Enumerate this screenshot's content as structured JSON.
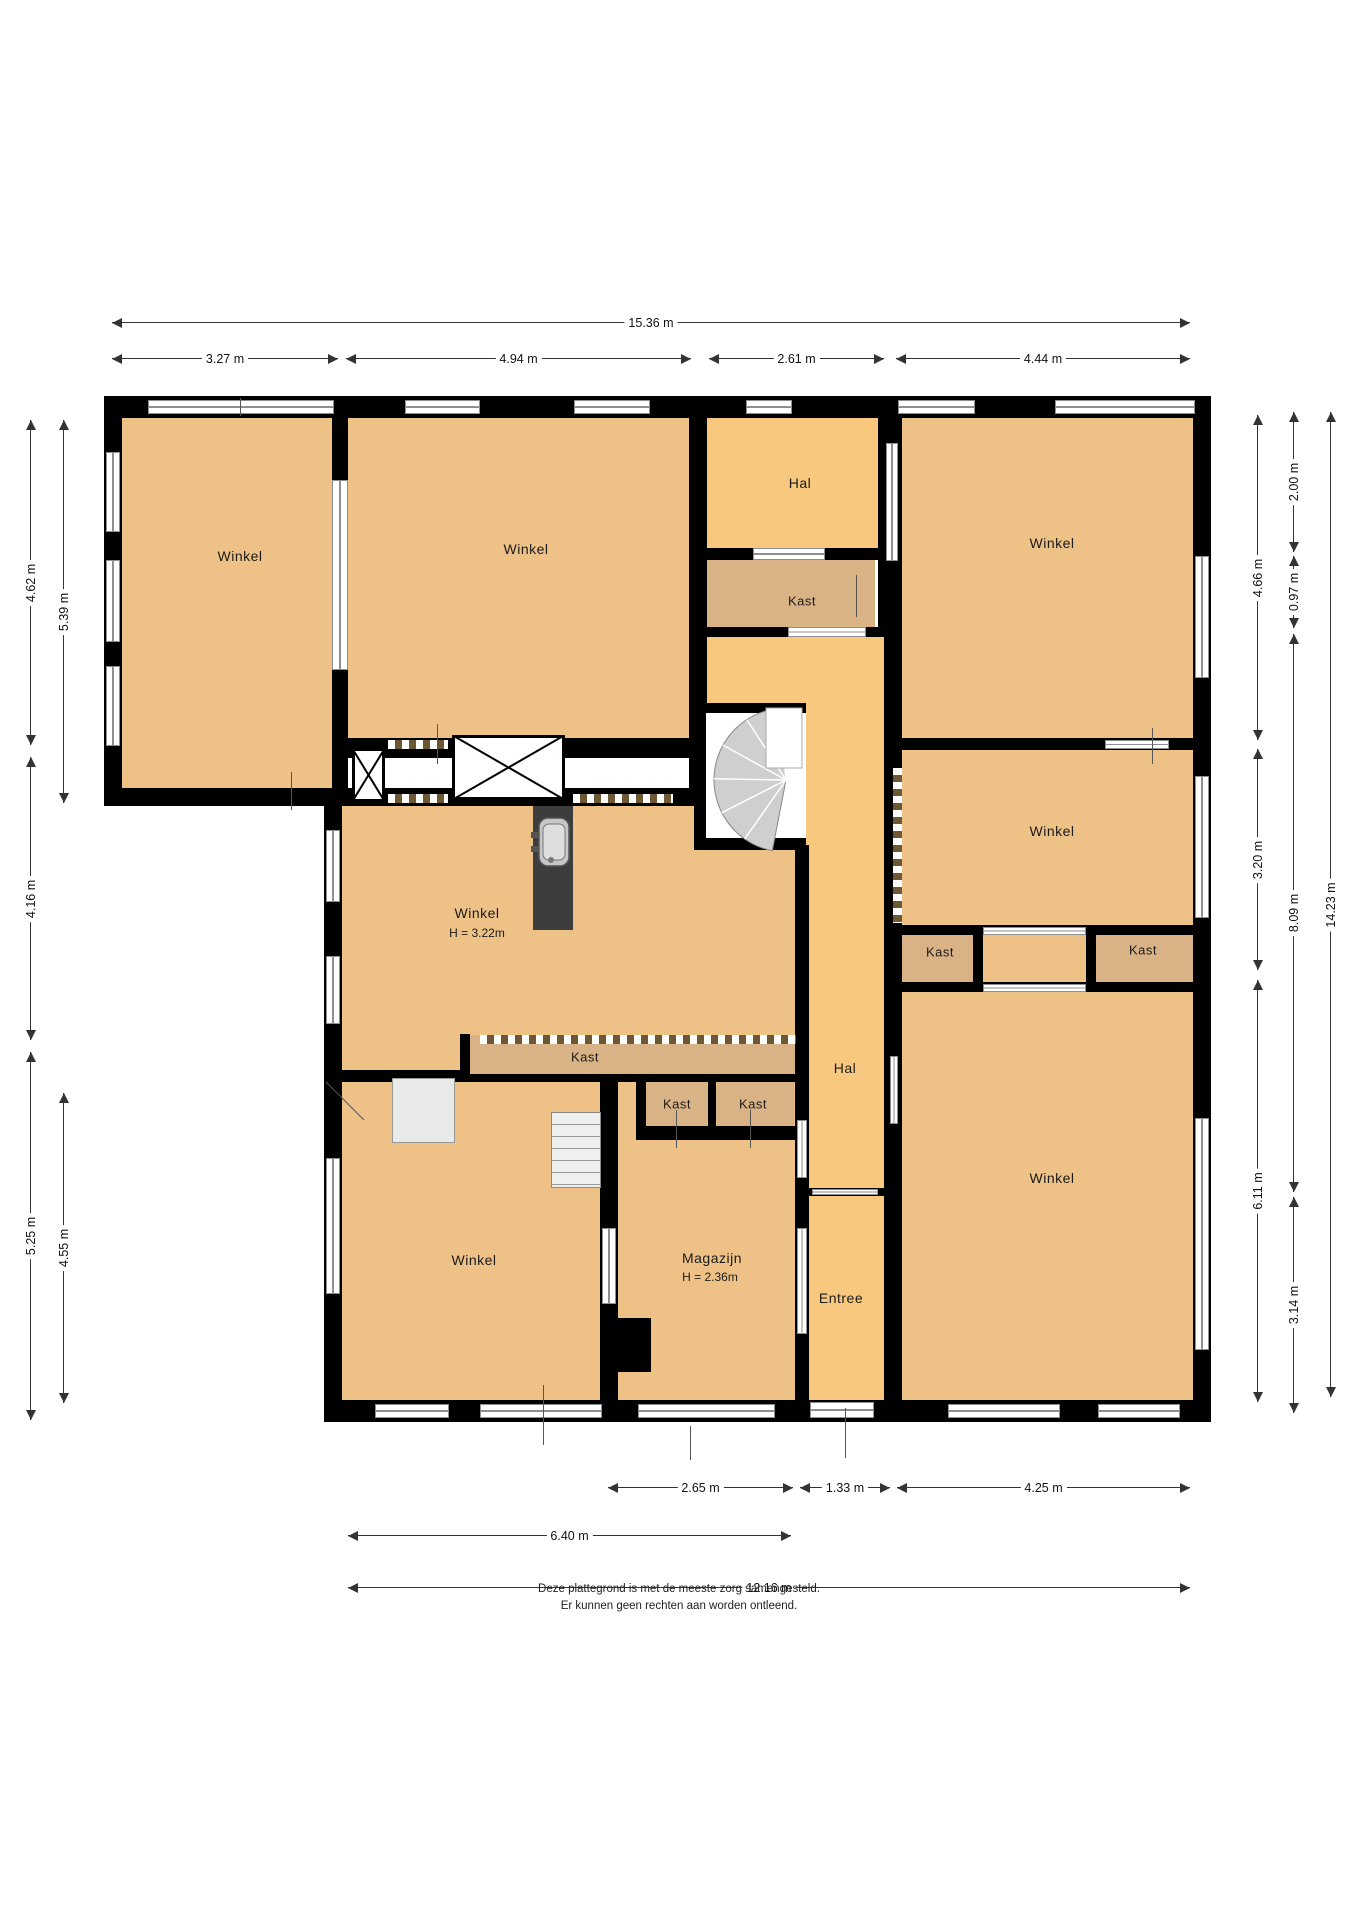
{
  "title": "floorplan",
  "colors": {
    "winkel": "#eec287",
    "hal": "#f7c87e",
    "kast": "#d9b386",
    "wall": "#000000",
    "window_frame": "#8f8f8f",
    "dim_line": "#333333",
    "stair_fan": "#cfcfcf"
  },
  "rooms": [
    {
      "x": 110,
      "y": 410,
      "w": 230,
      "h": 385,
      "fill": "winkel"
    },
    {
      "x": 340,
      "y": 410,
      "w": 360,
      "h": 340,
      "fill": "winkel"
    },
    {
      "x": 700,
      "y": 410,
      "w": 185,
      "h": 145,
      "fill": "hal"
    },
    {
      "x": 700,
      "y": 550,
      "w": 175,
      "h": 85,
      "fill": "kast"
    },
    {
      "x": 890,
      "y": 410,
      "w": 310,
      "h": 335,
      "fill": "winkel"
    },
    {
      "x": 890,
      "y": 740,
      "w": 310,
      "h": 190,
      "fill": "winkel"
    },
    {
      "x": 895,
      "y": 928,
      "w": 85,
      "h": 60,
      "fill": "kast"
    },
    {
      "x": 980,
      "y": 928,
      "w": 110,
      "h": 57,
      "fill": "winkel"
    },
    {
      "x": 1090,
      "y": 928,
      "w": 108,
      "h": 60,
      "fill": "kast"
    },
    {
      "x": 895,
      "y": 985,
      "w": 303,
      "h": 420,
      "fill": "winkel"
    },
    {
      "x": 700,
      "y": 630,
      "w": 185,
      "h": 215,
      "fill": "hal"
    },
    {
      "x": 790,
      "y": 840,
      "w": 100,
      "h": 355,
      "fill": "hal"
    },
    {
      "x": 790,
      "y": 1190,
      "w": 100,
      "h": 215,
      "fill": "hal"
    },
    {
      "x": 335,
      "y": 795,
      "w": 460,
      "h": 245,
      "fill": "winkel"
    },
    {
      "x": 335,
      "y": 1035,
      "w": 130,
      "h": 40,
      "fill": "winkel"
    },
    {
      "x": 465,
      "y": 1035,
      "w": 330,
      "h": 42,
      "fill": "kast"
    },
    {
      "x": 605,
      "y": 1078,
      "w": 195,
      "h": 327,
      "fill": "winkel"
    },
    {
      "x": 640,
      "y": 1078,
      "w": 72,
      "h": 52,
      "fill": "kast"
    },
    {
      "x": 714,
      "y": 1078,
      "w": 80,
      "h": 52,
      "fill": "kast"
    },
    {
      "x": 335,
      "y": 1075,
      "w": 270,
      "h": 330,
      "fill": "winkel"
    }
  ],
  "walls": [
    {
      "x": 104,
      "y": 396,
      "w": 1107,
      "h": 22
    },
    {
      "x": 104,
      "y": 396,
      "w": 18,
      "h": 410
    },
    {
      "x": 104,
      "y": 788,
      "w": 250,
      "h": 18
    },
    {
      "x": 324,
      "y": 788,
      "w": 18,
      "h": 634
    },
    {
      "x": 324,
      "y": 1400,
      "w": 887,
      "h": 22
    },
    {
      "x": 1193,
      "y": 396,
      "w": 18,
      "h": 1022
    },
    {
      "x": 332,
      "y": 418,
      "w": 16,
      "h": 372
    },
    {
      "x": 689,
      "y": 418,
      "w": 18,
      "h": 388
    },
    {
      "x": 878,
      "y": 418,
      "w": 24,
      "h": 219
    },
    {
      "x": 884,
      "y": 637,
      "w": 18,
      "h": 551
    },
    {
      "x": 884,
      "y": 1188,
      "w": 18,
      "h": 214
    },
    {
      "x": 348,
      "y": 738,
      "w": 341,
      "h": 20
    },
    {
      "x": 902,
      "y": 738,
      "w": 291,
      "h": 12
    },
    {
      "x": 352,
      "y": 788,
      "w": 337,
      "h": 18
    },
    {
      "x": 694,
      "y": 548,
      "w": 190,
      "h": 12
    },
    {
      "x": 694,
      "y": 627,
      "w": 190,
      "h": 10
    },
    {
      "x": 700,
      "y": 838,
      "w": 106,
      "h": 12
    },
    {
      "x": 694,
      "y": 703,
      "w": 12,
      "h": 147
    },
    {
      "x": 694,
      "y": 703,
      "w": 112,
      "h": 10
    },
    {
      "x": 795,
      "y": 845,
      "w": 14,
      "h": 343
    },
    {
      "x": 795,
      "y": 1188,
      "w": 14,
      "h": 216
    },
    {
      "x": 342,
      "y": 1070,
      "w": 120,
      "h": 12
    },
    {
      "x": 460,
      "y": 1034,
      "w": 10,
      "h": 48
    },
    {
      "x": 460,
      "y": 1074,
      "w": 338,
      "h": 8
    },
    {
      "x": 636,
      "y": 1082,
      "w": 10,
      "h": 48
    },
    {
      "x": 708,
      "y": 1082,
      "w": 8,
      "h": 48
    },
    {
      "x": 636,
      "y": 1126,
      "w": 162,
      "h": 14
    },
    {
      "x": 600,
      "y": 1082,
      "w": 18,
      "h": 318
    },
    {
      "x": 614,
      "y": 1318,
      "w": 37,
      "h": 54
    },
    {
      "x": 902,
      "y": 925,
      "w": 291,
      "h": 10
    },
    {
      "x": 902,
      "y": 982,
      "w": 291,
      "h": 10
    },
    {
      "x": 973,
      "y": 925,
      "w": 10,
      "h": 67
    },
    {
      "x": 1086,
      "y": 925,
      "w": 10,
      "h": 67
    },
    {
      "x": 809,
      "y": 1188,
      "w": 75,
      "h": 8
    }
  ],
  "windows": [
    {
      "x": 148,
      "y": 400,
      "w": 186,
      "h": 14,
      "o": "h"
    },
    {
      "x": 405,
      "y": 400,
      "w": 75,
      "h": 14,
      "o": "h"
    },
    {
      "x": 574,
      "y": 400,
      "w": 76,
      "h": 14,
      "o": "h"
    },
    {
      "x": 746,
      "y": 400,
      "w": 46,
      "h": 14,
      "o": "h"
    },
    {
      "x": 898,
      "y": 400,
      "w": 77,
      "h": 14,
      "o": "h"
    },
    {
      "x": 1055,
      "y": 400,
      "w": 140,
      "h": 14,
      "o": "h"
    },
    {
      "x": 106,
      "y": 452,
      "w": 14,
      "h": 80,
      "o": "v"
    },
    {
      "x": 106,
      "y": 560,
      "w": 14,
      "h": 82,
      "o": "v"
    },
    {
      "x": 106,
      "y": 666,
      "w": 14,
      "h": 80,
      "o": "v"
    },
    {
      "x": 326,
      "y": 830,
      "w": 14,
      "h": 72,
      "o": "v"
    },
    {
      "x": 326,
      "y": 956,
      "w": 14,
      "h": 68,
      "o": "v"
    },
    {
      "x": 326,
      "y": 1158,
      "w": 14,
      "h": 136,
      "o": "v"
    },
    {
      "x": 1195,
      "y": 556,
      "w": 14,
      "h": 122,
      "o": "v"
    },
    {
      "x": 1195,
      "y": 776,
      "w": 14,
      "h": 142,
      "o": "v"
    },
    {
      "x": 1195,
      "y": 1118,
      "w": 14,
      "h": 232,
      "o": "v"
    },
    {
      "x": 375,
      "y": 1404,
      "w": 74,
      "h": 14,
      "o": "h"
    },
    {
      "x": 480,
      "y": 1404,
      "w": 122,
      "h": 14,
      "o": "h"
    },
    {
      "x": 638,
      "y": 1404,
      "w": 137,
      "h": 14,
      "o": "h"
    },
    {
      "x": 810,
      "y": 1402,
      "w": 64,
      "h": 16,
      "o": "h"
    },
    {
      "x": 948,
      "y": 1404,
      "w": 112,
      "h": 14,
      "o": "h"
    },
    {
      "x": 1098,
      "y": 1404,
      "w": 82,
      "h": 14,
      "o": "h"
    },
    {
      "x": 332,
      "y": 480,
      "w": 16,
      "h": 190,
      "o": "v"
    },
    {
      "x": 886,
      "y": 443,
      "w": 12,
      "h": 118,
      "o": "v"
    },
    {
      "x": 753,
      "y": 548,
      "w": 72,
      "h": 12,
      "o": "h"
    },
    {
      "x": 788,
      "y": 627,
      "w": 78,
      "h": 10,
      "o": "h"
    },
    {
      "x": 890,
      "y": 1056,
      "w": 8,
      "h": 68,
      "o": "v"
    },
    {
      "x": 797,
      "y": 1120,
      "w": 10,
      "h": 58,
      "o": "v"
    },
    {
      "x": 797,
      "y": 1228,
      "w": 10,
      "h": 106,
      "o": "v"
    },
    {
      "x": 812,
      "y": 1189,
      "w": 66,
      "h": 6,
      "o": "h"
    },
    {
      "x": 983,
      "y": 927,
      "w": 103,
      "h": 8,
      "o": "h"
    },
    {
      "x": 983,
      "y": 984,
      "w": 103,
      "h": 8,
      "o": "h"
    },
    {
      "x": 602,
      "y": 1228,
      "w": 14,
      "h": 76,
      "o": "v"
    },
    {
      "x": 1105,
      "y": 740,
      "w": 64,
      "h": 9,
      "o": "h"
    }
  ],
  "dashes": [
    {
      "x": 388,
      "y": 740,
      "w": 60,
      "h": 9,
      "o": "h"
    },
    {
      "x": 388,
      "y": 794,
      "w": 60,
      "h": 9,
      "o": "h"
    },
    {
      "x": 573,
      "y": 794,
      "w": 100,
      "h": 9,
      "o": "h"
    },
    {
      "x": 480,
      "y": 1035,
      "w": 316,
      "h": 9,
      "o": "h"
    },
    {
      "x": 893,
      "y": 768,
      "w": 9,
      "h": 155,
      "o": "v"
    }
  ],
  "ticks": [
    {
      "x": 291,
      "y": 772,
      "w": 1,
      "h": 38
    },
    {
      "x": 437,
      "y": 724,
      "w": 1,
      "h": 40
    },
    {
      "x": 856,
      "y": 575,
      "w": 1,
      "h": 42
    },
    {
      "x": 1152,
      "y": 728,
      "w": 1,
      "h": 36
    },
    {
      "x": 543,
      "y": 1385,
      "w": 1,
      "h": 60
    },
    {
      "x": 690,
      "y": 1426,
      "w": 1,
      "h": 34
    },
    {
      "x": 845,
      "y": 1408,
      "w": 1,
      "h": 50
    },
    {
      "x": 676,
      "y": 1110,
      "w": 1,
      "h": 38
    },
    {
      "x": 750,
      "y": 1110,
      "w": 1,
      "h": 38
    },
    {
      "x": 240,
      "y": 398,
      "w": 1,
      "h": 18
    }
  ],
  "furniture": {
    "shafts": [
      {
        "x": 352,
        "y": 748,
        "w": 33,
        "h": 54
      },
      {
        "x": 452,
        "y": 735,
        "w": 113,
        "h": 65
      }
    ],
    "counter": {
      "x": 533,
      "y": 806,
      "w": 40,
      "h": 124
    },
    "platform": {
      "x": 392,
      "y": 1078,
      "w": 63,
      "h": 65
    },
    "stairs": {
      "x": 551,
      "y": 1112,
      "w": 50,
      "h": 76
    },
    "spiral": {
      "cx": 786,
      "cy": 780,
      "r": 72,
      "a0": 95,
      "a1": 262,
      "box": {
        "x": 706,
        "y": 713,
        "w": 100,
        "h": 125
      },
      "landing": {
        "x": 766,
        "y": 708,
        "w": 36,
        "h": 60
      }
    },
    "swing": {
      "x1": 326,
      "y1": 1082,
      "x2": 364,
      "y2": 1120
    },
    "sink": {
      "x": 539,
      "y": 818,
      "w": 30,
      "h": 48
    }
  },
  "labels": [
    {
      "x": 240,
      "y": 556,
      "text": "Winkel",
      "cls": "room",
      "name": "room-label-winkel-topleft"
    },
    {
      "x": 526,
      "y": 549,
      "text": "Winkel",
      "cls": "room",
      "name": "room-label-winkel-topmid"
    },
    {
      "x": 800,
      "y": 483,
      "text": "Hal",
      "cls": "room",
      "name": "room-label-hal-top"
    },
    {
      "x": 802,
      "y": 601,
      "text": "Kast",
      "cls": "small",
      "name": "room-label-kast-top"
    },
    {
      "x": 1052,
      "y": 543,
      "text": "Winkel",
      "cls": "room",
      "name": "room-label-winkel-topright"
    },
    {
      "x": 1052,
      "y": 831,
      "text": "Winkel",
      "cls": "room",
      "name": "room-label-winkel-right"
    },
    {
      "x": 477,
      "y": 913,
      "text": "Winkel",
      "cls": "room",
      "name": "room-label-winkel-mid"
    },
    {
      "x": 477,
      "y": 933,
      "text": "H = 3.22m",
      "cls": "height",
      "name": "room-label-winkel-mid-height"
    },
    {
      "x": 585,
      "y": 1057,
      "text": "Kast",
      "cls": "small",
      "name": "room-label-kast-strip"
    },
    {
      "x": 677,
      "y": 1104,
      "text": "Kast",
      "cls": "small",
      "name": "room-label-kast-a"
    },
    {
      "x": 753,
      "y": 1104,
      "text": "Kast",
      "cls": "small",
      "name": "room-label-kast-b"
    },
    {
      "x": 940,
      "y": 952,
      "text": "Kast",
      "cls": "small",
      "name": "room-label-kast-right-a"
    },
    {
      "x": 1143,
      "y": 950,
      "text": "Kast",
      "cls": "small",
      "name": "room-label-kast-right-b"
    },
    {
      "x": 845,
      "y": 1068,
      "text": "Hal",
      "cls": "room",
      "name": "room-label-hal-corridor"
    },
    {
      "x": 1052,
      "y": 1178,
      "text": "Winkel",
      "cls": "room",
      "name": "room-label-winkel-bottomright"
    },
    {
      "x": 474,
      "y": 1260,
      "text": "Winkel",
      "cls": "room",
      "name": "room-label-winkel-bottomleft"
    },
    {
      "x": 712,
      "y": 1258,
      "text": "Magazijn",
      "cls": "room",
      "name": "room-label-magazijn"
    },
    {
      "x": 710,
      "y": 1277,
      "text": "H = 2.36m",
      "cls": "height",
      "name": "room-label-magazijn-height"
    },
    {
      "x": 841,
      "y": 1298,
      "text": "Entree",
      "cls": "room",
      "name": "room-label-entree"
    }
  ],
  "dims": {
    "h": [
      {
        "x1": 112,
        "x2": 1190,
        "y": 322,
        "label": "15.36 m"
      },
      {
        "x1": 112,
        "x2": 338,
        "y": 358,
        "label": "3.27 m"
      },
      {
        "x1": 346,
        "x2": 691,
        "y": 358,
        "label": "4.94 m"
      },
      {
        "x1": 709,
        "x2": 884,
        "y": 358,
        "label": "2.61 m"
      },
      {
        "x1": 896,
        "x2": 1190,
        "y": 358,
        "label": "4.44 m"
      },
      {
        "x1": 608,
        "x2": 793,
        "y": 1487,
        "label": "2.65 m"
      },
      {
        "x1": 800,
        "x2": 890,
        "y": 1487,
        "label": "1.33 m"
      },
      {
        "x1": 897,
        "x2": 1190,
        "y": 1487,
        "label": "4.25 m"
      },
      {
        "x1": 348,
        "x2": 791,
        "y": 1535,
        "label": "6.40 m"
      },
      {
        "x1": 348,
        "x2": 1190,
        "y": 1587,
        "label": "12.16 m"
      }
    ],
    "v": [
      {
        "x": 30,
        "y1": 420,
        "y2": 745,
        "label": "4.62 m"
      },
      {
        "x": 30,
        "y1": 757,
        "y2": 1040,
        "label": "4.16 m"
      },
      {
        "x": 30,
        "y1": 1052,
        "y2": 1420,
        "label": "5.25 m"
      },
      {
        "x": 63,
        "y1": 420,
        "y2": 803,
        "label": "5.39 m"
      },
      {
        "x": 63,
        "y1": 1093,
        "y2": 1403,
        "label": "4.55 m"
      },
      {
        "x": 1257,
        "y1": 415,
        "y2": 740,
        "label": "4.66 m"
      },
      {
        "x": 1257,
        "y1": 749,
        "y2": 970,
        "label": "3.20 m"
      },
      {
        "x": 1257,
        "y1": 980,
        "y2": 1402,
        "label": "6.11 m"
      },
      {
        "x": 1293,
        "y1": 412,
        "y2": 552,
        "label": "2.00 m"
      },
      {
        "x": 1293,
        "y1": 556,
        "y2": 628,
        "label": "0.97 m"
      },
      {
        "x": 1293,
        "y1": 634,
        "y2": 1192,
        "label": "8.09 m"
      },
      {
        "x": 1293,
        "y1": 1197,
        "y2": 1413,
        "label": "3.14 m"
      },
      {
        "x": 1330,
        "y1": 412,
        "y2": 1397,
        "label": "14.23 m"
      }
    ]
  },
  "footer": {
    "line1": "Deze plattegrond is met de meeste zorg samengesteld.",
    "line2": "Er kunnen geen rechten aan worden ontleend."
  }
}
